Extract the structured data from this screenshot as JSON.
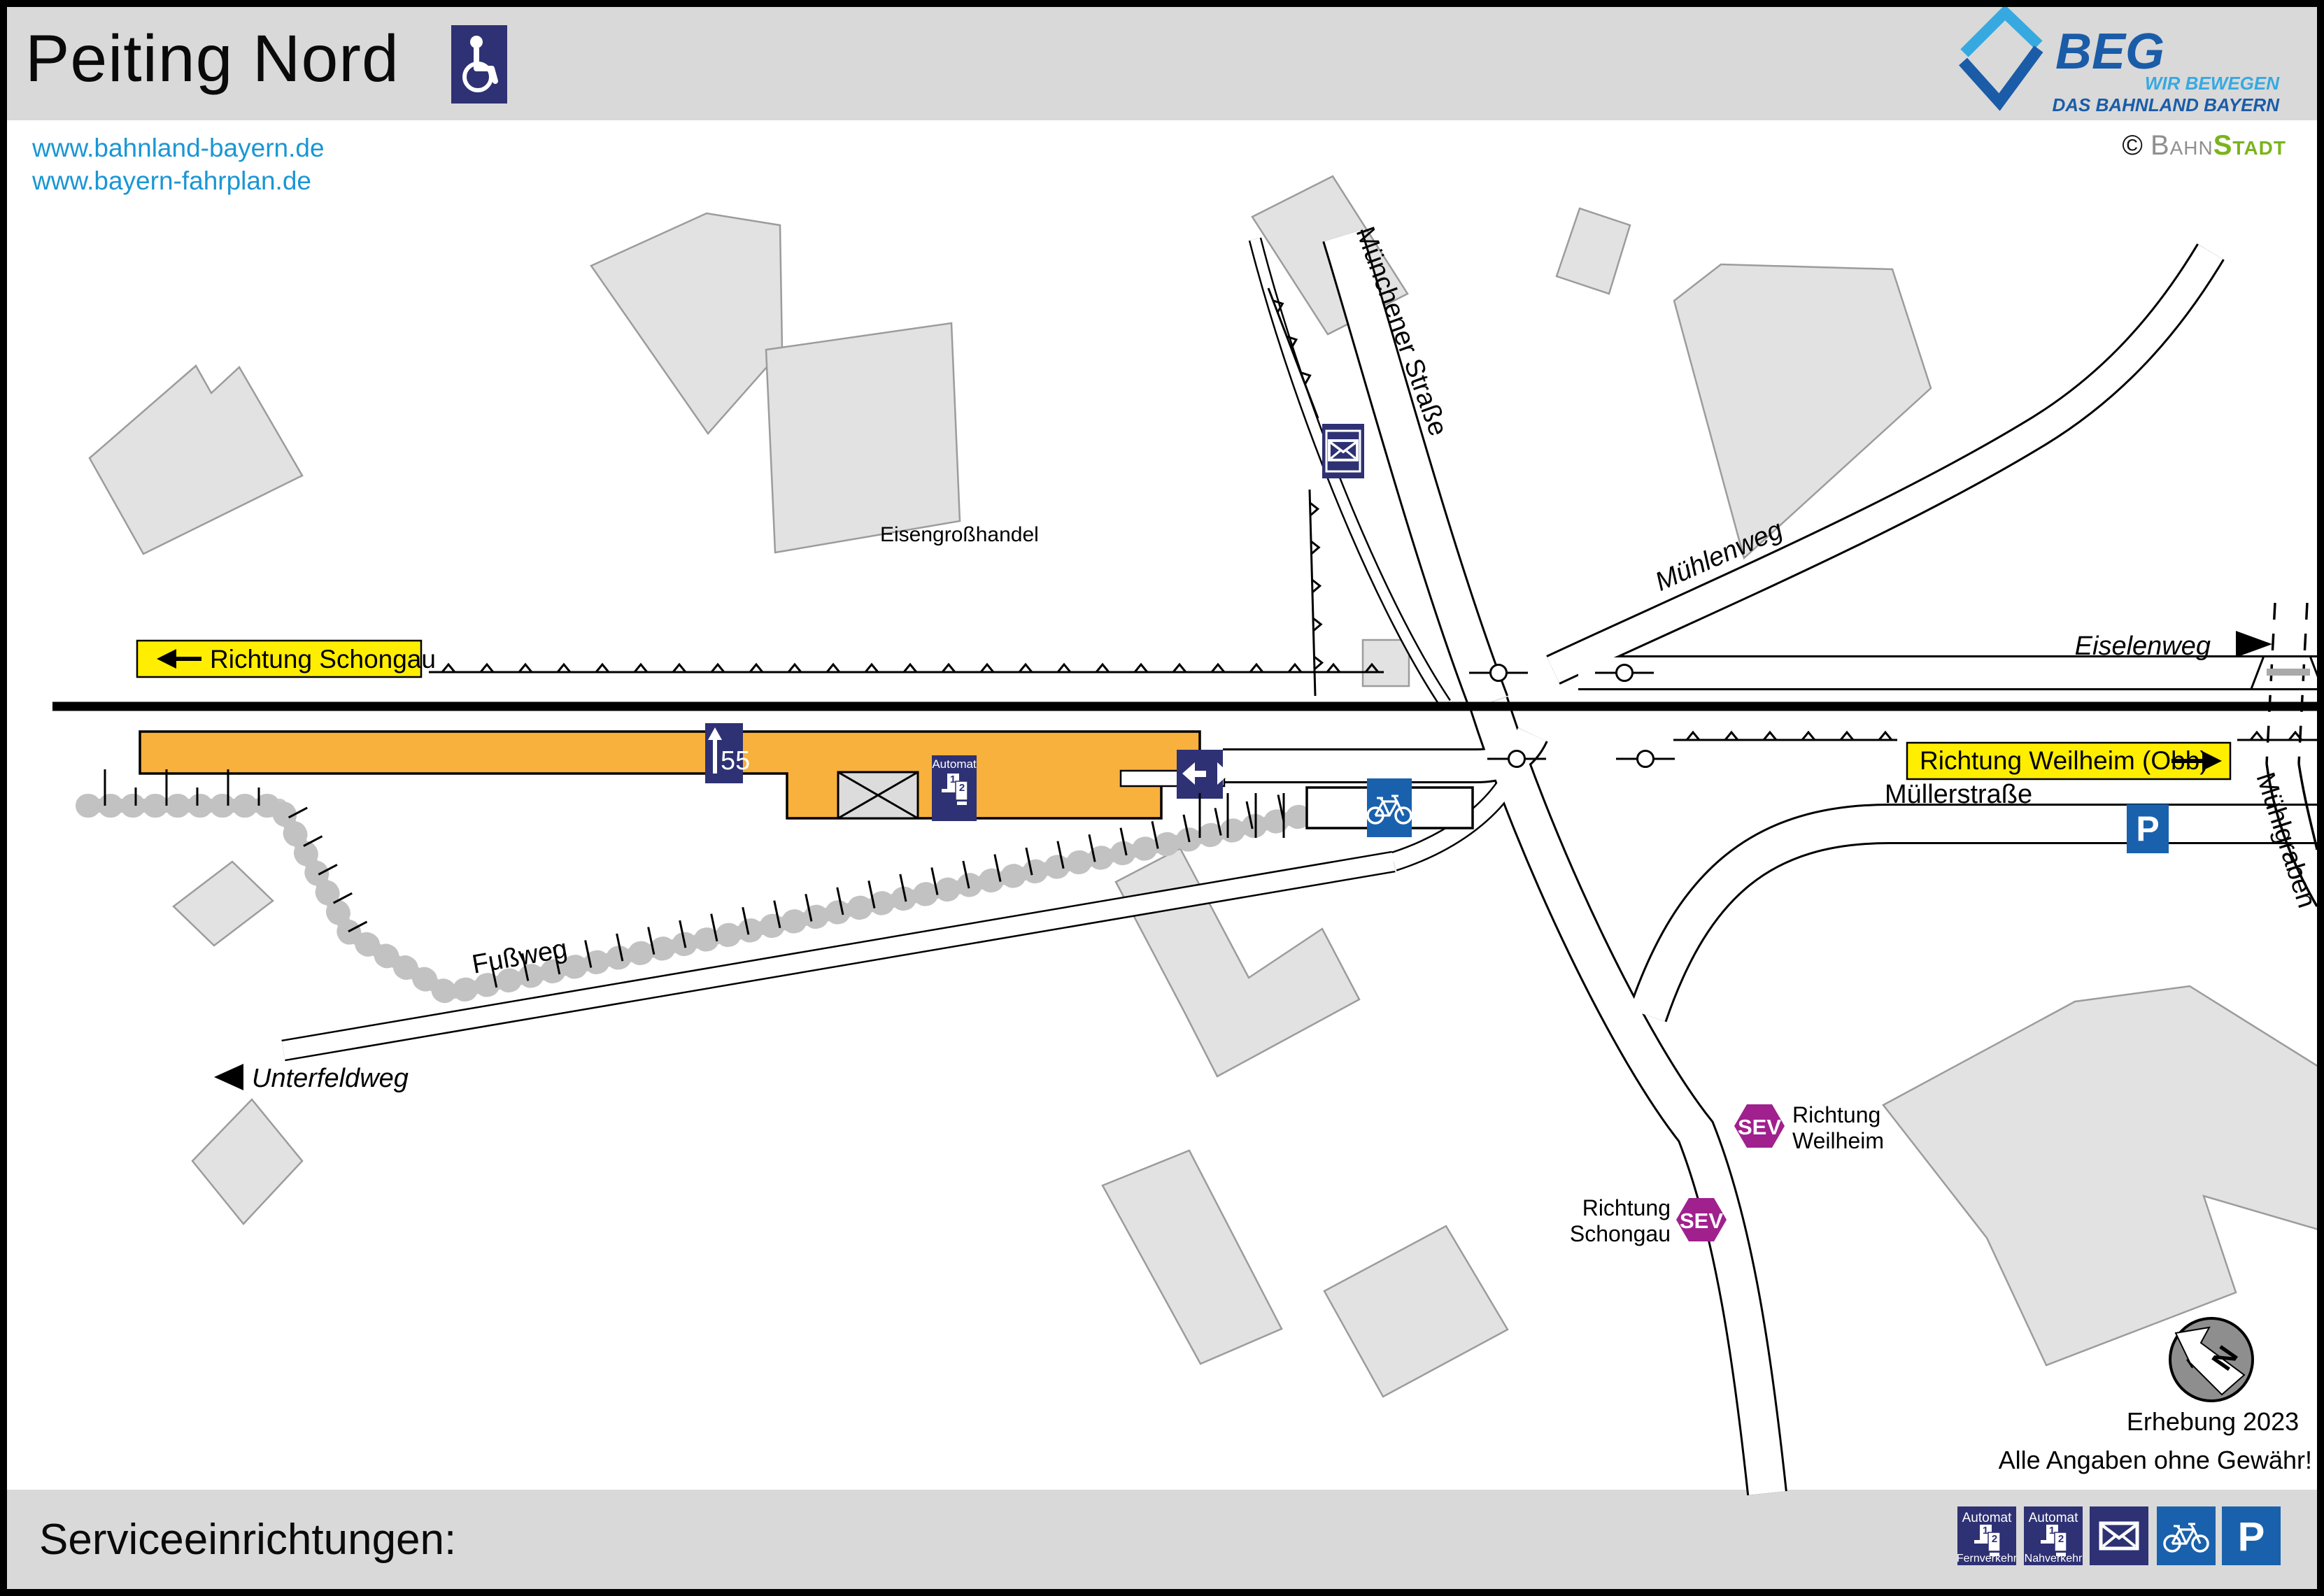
{
  "header": {
    "title": "Peiting Nord"
  },
  "links": {
    "items": [
      {
        "text": "www.bahnland-bayern.de"
      },
      {
        "text": "www.bayern-fahrplan.de"
      }
    ]
  },
  "branding": {
    "beg_name": "BEG",
    "beg_tagline1": "WIR BEWEGEN",
    "beg_tagline2": "DAS BAHNLAND BAYERN",
    "credit_symbol": "©",
    "credit_part1": "Bahn",
    "credit_part2": "Stadt"
  },
  "map": {
    "streets": {
      "muenchener_strasse": "Münchener Straße",
      "muehlenweg": "Mühlenweg",
      "eiselenweg": "Eiselenweg",
      "muellerstrasse": "Müllerstraße",
      "muehlgraben": "Mühlgraben",
      "fussweg": "Fußweg",
      "unterfeldweg": "Unterfeldweg"
    },
    "poi": {
      "eisengrosshandel": "Eisengroßhandel"
    },
    "directions": {
      "left": "Richtung Schongau",
      "right": "Richtung Weilheim (Obb)"
    },
    "platform": {
      "track_number": "55",
      "automat_label": "Automat",
      "machine_no_1": "1",
      "machine_no_2": "2"
    },
    "sev": {
      "badge": "SEV",
      "stop_weilheim_line1": "Richtung",
      "stop_weilheim_line2": "Weilheim",
      "stop_schongau_line1": "Richtung",
      "stop_schongau_line2": "Schongau"
    },
    "north_letter": "N",
    "survey_note": "Erhebung 2023",
    "disclaimer": "Alle Angaben ohne Gewähr!"
  },
  "footer": {
    "heading": "Serviceeinrichtungen:",
    "legend": [
      {
        "name": "ticket-machine-long-distance",
        "label_top": "Automat",
        "label_bottom": "Fernverkehr"
      },
      {
        "name": "ticket-machine-regional",
        "label_top": "Automat",
        "label_bottom": "Nahverkehr"
      },
      {
        "name": "mailbox"
      },
      {
        "name": "bike-parking"
      },
      {
        "name": "parking",
        "letter": "P"
      }
    ]
  },
  "colors": {
    "accent_navy": "#2e3173",
    "accent_blue": "#1961ac",
    "accent_purple": "#a0208e",
    "accent_yellow": "#ffee00",
    "platform_orange": "#f8b13c",
    "link_blue": "#1a96d4",
    "beg_dark_blue": "#1a5ca8",
    "beg_light_blue": "#36a9e1",
    "bahnstadt_green": "#7ab41d",
    "band_gray": "#d9d9d9"
  }
}
